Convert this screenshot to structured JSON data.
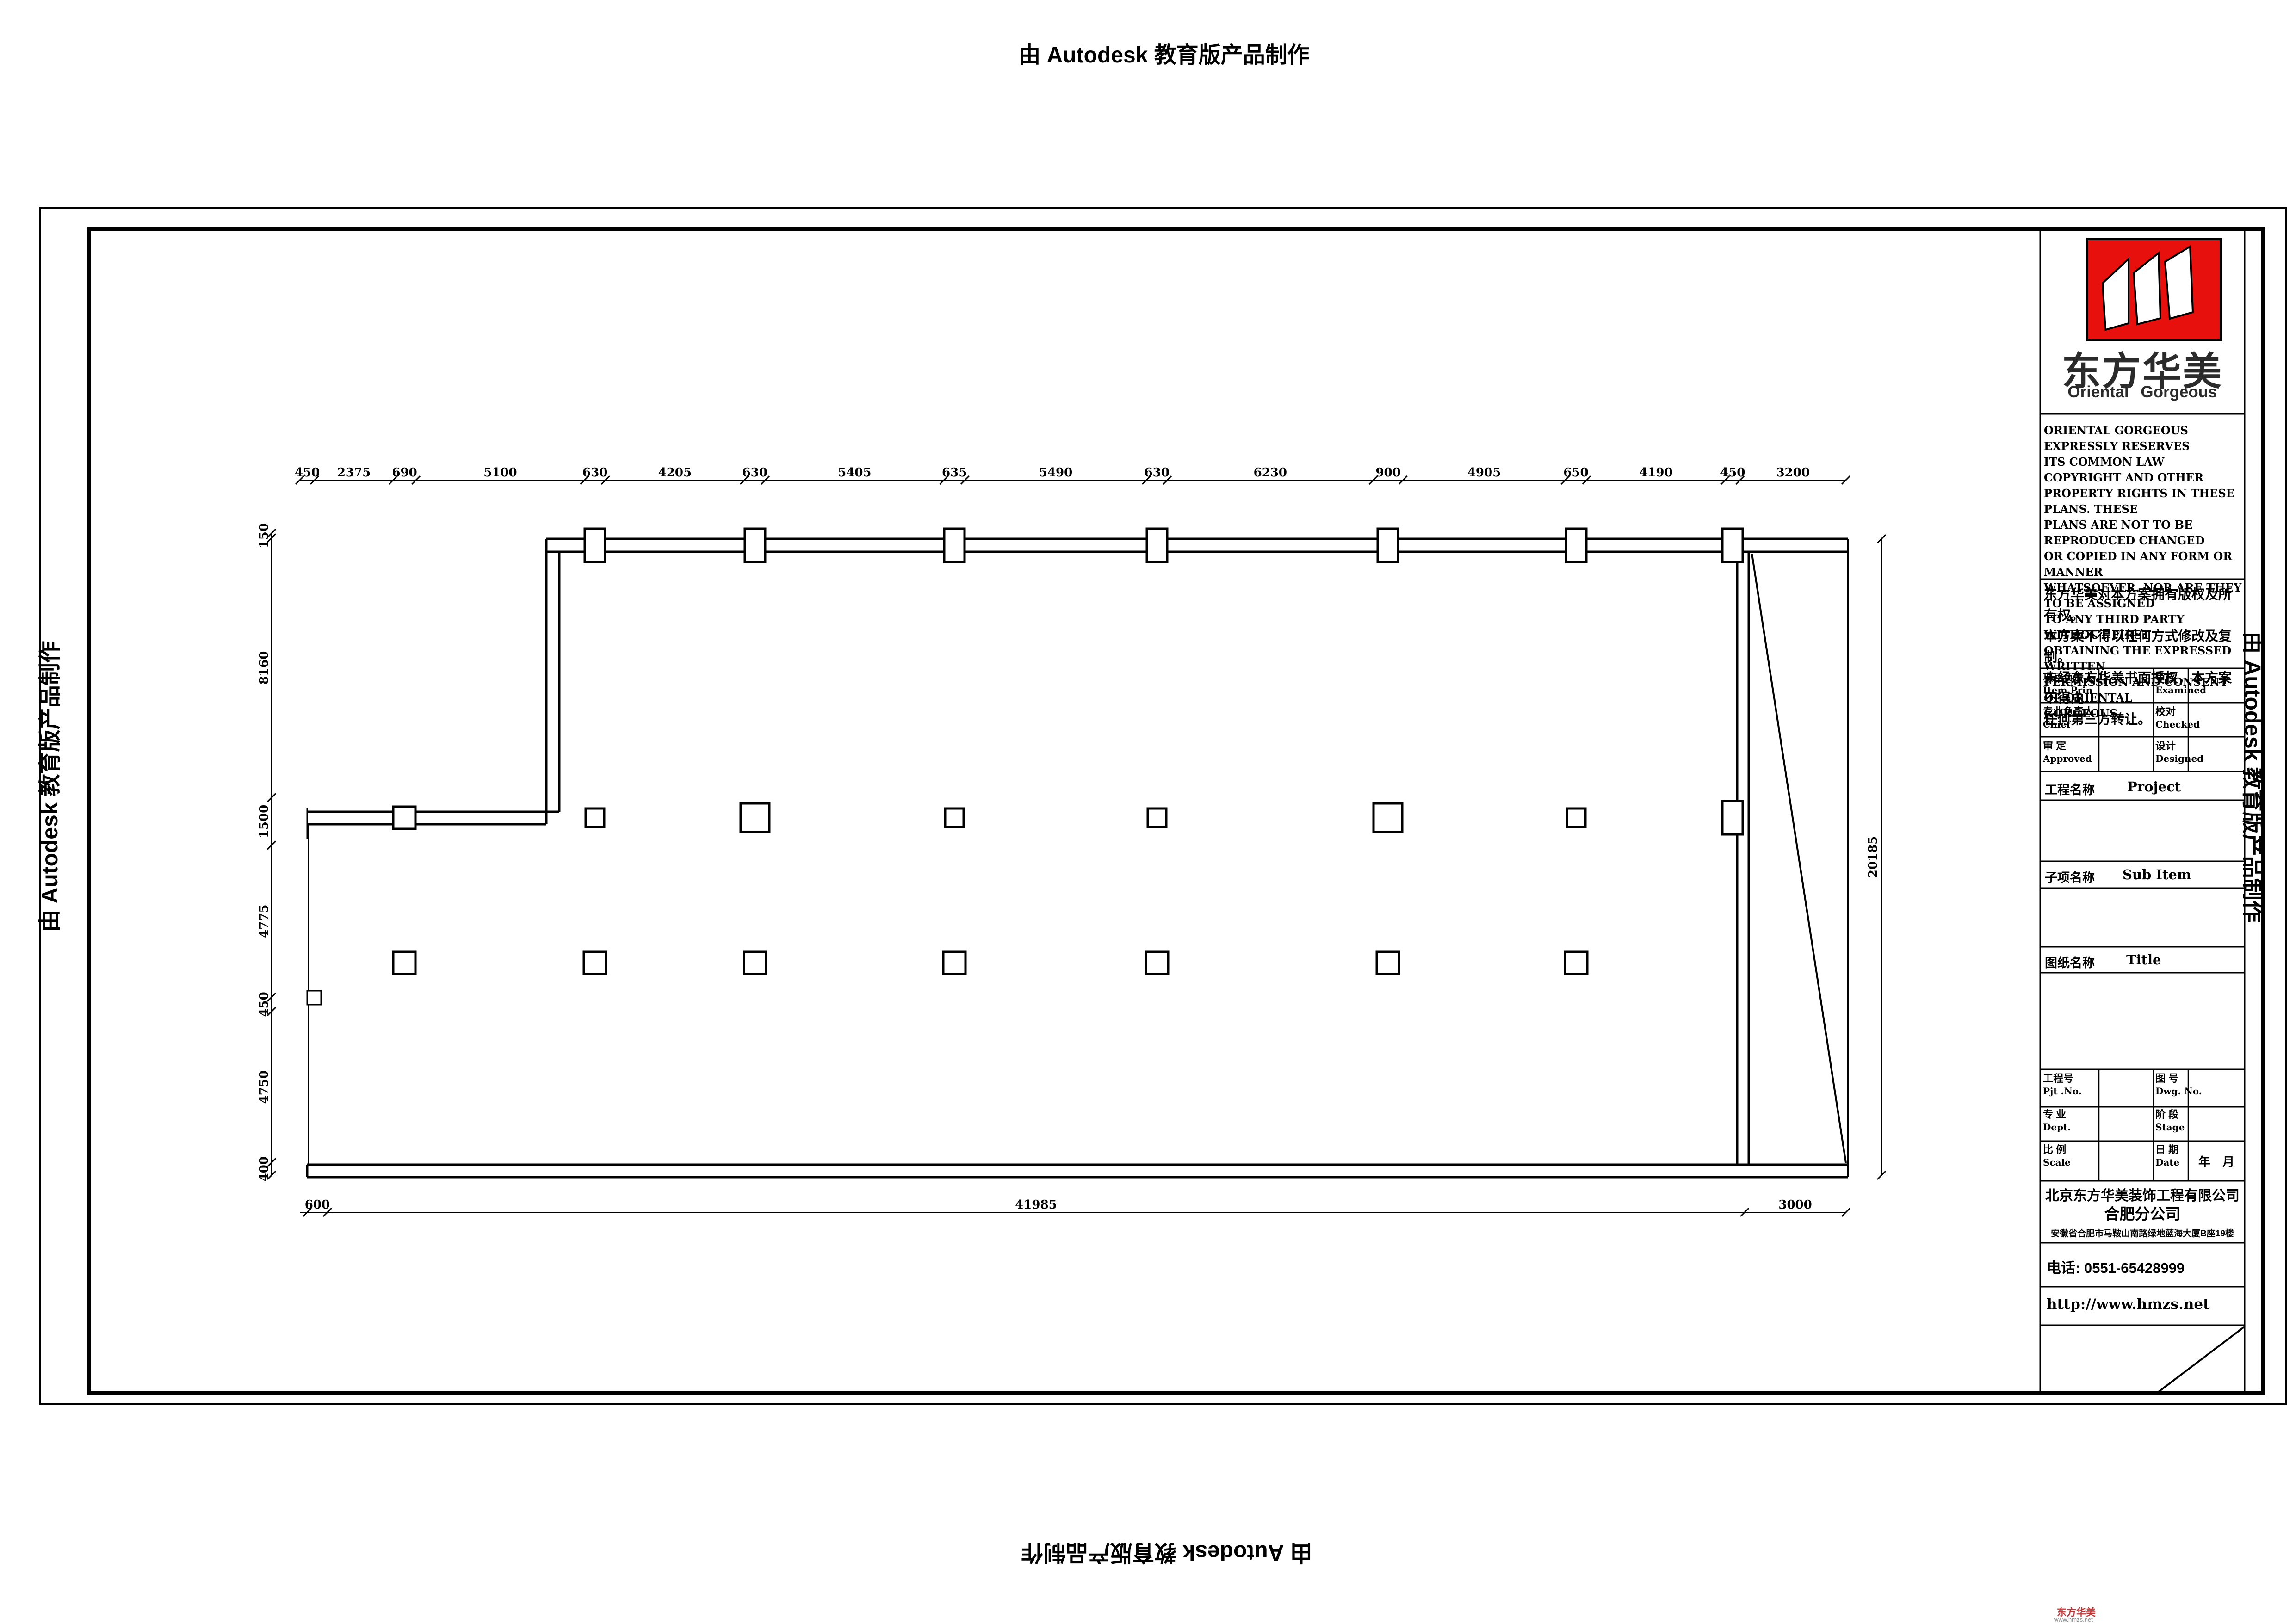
{
  "watermark": {
    "text": "由 Autodesk 教育版产品制作"
  },
  "plan": {
    "top_dims": [
      "450",
      "2375",
      "690",
      "5100",
      "630",
      "4205",
      "630",
      "5405",
      "635",
      "5490",
      "630",
      "6230",
      "900",
      "4905",
      "650",
      "4190",
      "450",
      "3200"
    ],
    "left_dims": [
      "150",
      "8160",
      "1500",
      "4775",
      "450",
      "4750",
      "400"
    ],
    "bottom_dims": [
      "600",
      "41985",
      "3000"
    ],
    "right_total": "20185"
  },
  "title_block": {
    "logo": {
      "brand_cn": "东方华美",
      "brand_en": "Oriental Gorgeous",
      "red": "#e8100c"
    },
    "copyright_en": [
      "ORIENTAL GORGEOUS EXPRESSLY RESERVES",
      "ITS COMMON LAW COPYRIGHT AND OTHER",
      "PROPERTY RIGHTS IN THESE PLANS. THESE",
      "PLANS ARE NOT TO BE REPRODUCED CHANGED",
      "OR COPIED IN ANY FORM OR MANNER",
      "WHATSOEVER. NOR ARE THEY TO BE ASSIGNED",
      "TO ANY THIRD PARTY WITHOUT FIRST",
      "OBTAINING THE EXPRESSED WRITTEN",
      "PERMISSION AND CONSENT OF ORIENTAL",
      "GORGEOUS"
    ],
    "copyright_cn": [
      "东方华美对本方案拥有版权及所有权。",
      "本方案不得以任何方式修改及复制。",
      "未经东方华美书面授权，本方案不得向",
      "任何第三方转让。"
    ],
    "personnel": {
      "rows": [
        {
          "cn1": "项目负责人",
          "en1": "Item.Prin",
          "cn2": "审核",
          "en2": "Examined"
        },
        {
          "cn1": "专业负责人",
          "en1": "Chief",
          "cn2": "校对",
          "en2": "Checked"
        },
        {
          "cn1": "审 定",
          "en1": "Approved",
          "cn2": "设计",
          "en2": "Designed"
        }
      ]
    },
    "sections": {
      "project_cn": "工程名称",
      "project_en": "Project",
      "subitem_cn": "子项名称",
      "subitem_en": "Sub Item",
      "title_cn": "图纸名称",
      "title_en": "Title"
    },
    "meta": {
      "rows": [
        {
          "cn1": "工程号",
          "en1": "Pjt .No.",
          "cn2": "图 号",
          "en2": "Dwg. No.",
          "val2": ""
        },
        {
          "cn1": "专 业",
          "en1": "Dept.",
          "cn2": "阶 段",
          "en2": "Stage",
          "val2": ""
        },
        {
          "cn1": "比 例",
          "en1": "Scale",
          "cn2": "日 期",
          "en2": "Date",
          "val2": "年　月"
        }
      ]
    },
    "company": {
      "name": "北京东方华美装饰工程有限公司",
      "branch": "合肥分公司",
      "address": "安徽省合肥市马鞍山南路绿地蓝海大厦B座19楼",
      "phone": "电话: 0551-65428999",
      "website": "http://www.hmzs.net"
    }
  },
  "corner_mark": {
    "brand": "东方华美",
    "site": "www.hmzs.net"
  }
}
